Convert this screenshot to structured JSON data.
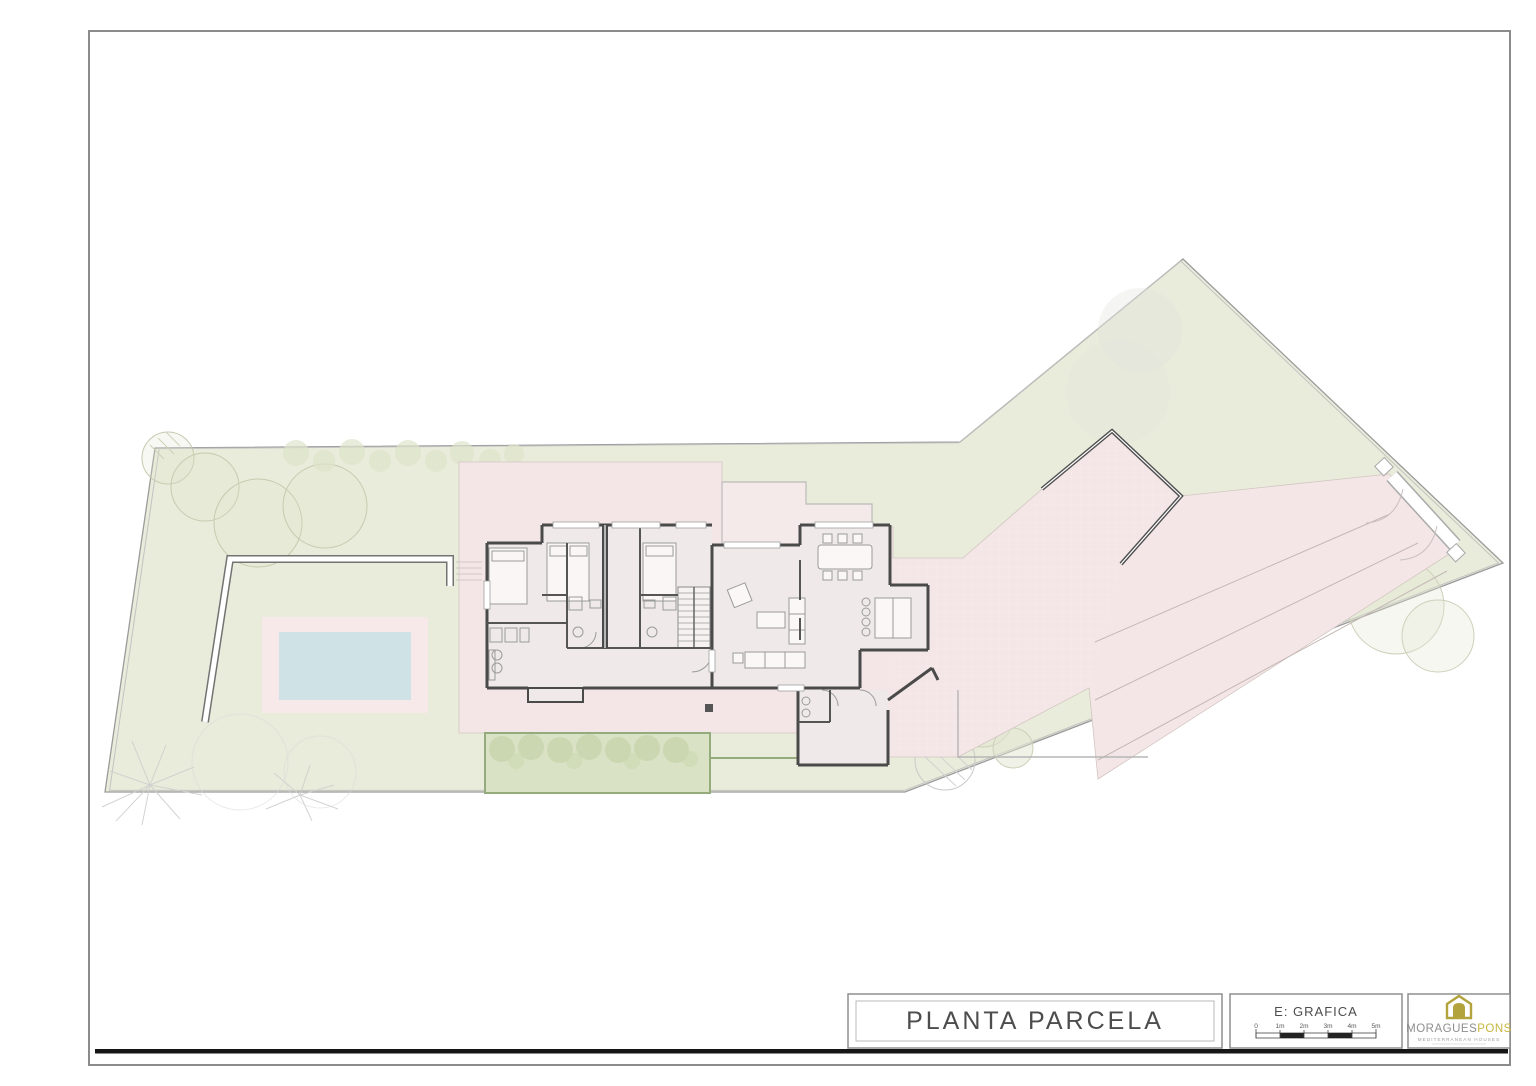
{
  "document": {
    "kind": "architectural-site-plan",
    "sheet_title": "PLANTA PARCELA"
  },
  "title_block": {
    "title": "PLANTA PARCELA",
    "scale": {
      "label": "E: GRAFICA",
      "ticks": [
        "0",
        "1m",
        "2m",
        "3m",
        "4m",
        "5m"
      ]
    },
    "brand": {
      "name_primary": "MORAGUES",
      "name_accent": "PONS",
      "tagline": "MEDITERRANEAN HOUSES"
    }
  },
  "colors": {
    "grass": "#e9ecda",
    "paving": "#f4e6e6",
    "room": "#f0e9ea",
    "pool": "#cfe3e7",
    "pool_deck": "#f7e9e9",
    "hedge": "#d9e2c4",
    "hedge_border": "#94ac7c",
    "wall_dark": "#4a4a4a",
    "accent_gold": "#b3a33c",
    "frame_gray": "#8b8b8b",
    "heavy_rule": "#161616"
  }
}
